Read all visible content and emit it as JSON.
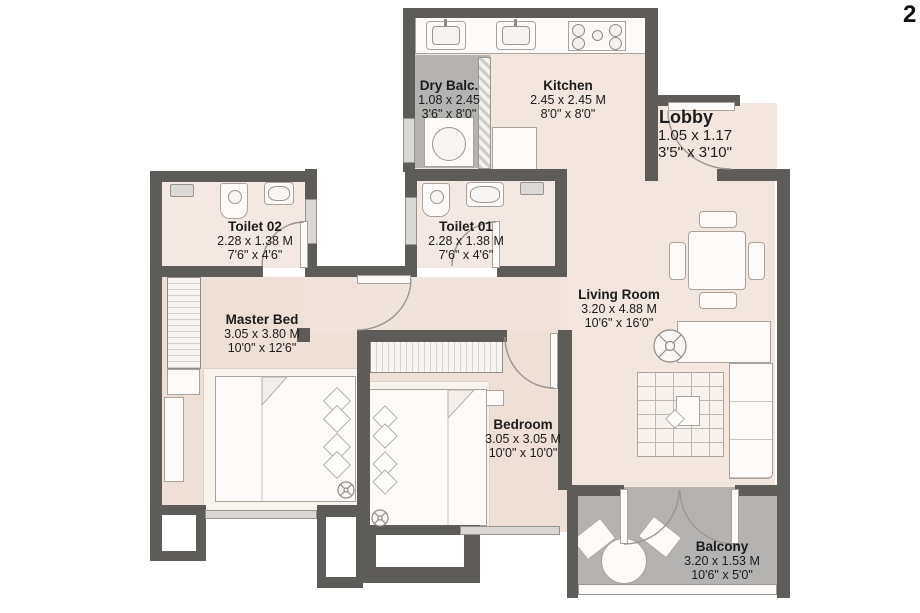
{
  "page": {
    "corner_mark": "2"
  },
  "colors": {
    "wall": "#5d5c59",
    "text": "#1c1c1c",
    "pink": "#f2e6df",
    "pinkdeep": "#eedfd7",
    "gray": "#b4b3b1"
  },
  "rooms": [
    {
      "id": "dry_balc",
      "name": "Dry Balc.",
      "dim_m": "1.08 x 2.45",
      "dim_ft": "3'6\" x 8'0\""
    },
    {
      "id": "kitchen",
      "name": "Kitchen",
      "dim_m": "2.45 x 2.45 M",
      "dim_ft": "8'0\" x 8'0\""
    },
    {
      "id": "lobby",
      "name": "Lobby",
      "dim_m": "1.05 x 1.17",
      "dim_ft": "3'5\" x 3'10\""
    },
    {
      "id": "toilet02",
      "name": "Toilet 02",
      "dim_m": "2.28 x 1.38 M",
      "dim_ft": "7'6\" x 4'6\""
    },
    {
      "id": "toilet01",
      "name": "Toilet 01",
      "dim_m": "2.28 x 1.38 M",
      "dim_ft": "7'6\" x 4'6\""
    },
    {
      "id": "living",
      "name": "Living Room",
      "dim_m": "3.20 x 4.88 M",
      "dim_ft": "10'6\" x 16'0\""
    },
    {
      "id": "master",
      "name": "Master Bed",
      "dim_m": "3.05 x 3.80 M",
      "dim_ft": "10'0\" x 12'6\""
    },
    {
      "id": "bedroom",
      "name": "Bedroom",
      "dim_m": "3.05 x 3.05 M",
      "dim_ft": "10'0\" x 10'0\""
    },
    {
      "id": "balcony",
      "name": "Balcony",
      "dim_m": "3.20 x 1.53 M",
      "dim_ft": "10'6\" x 5'0\""
    }
  ],
  "icons": [
    "kitchen-sink-icon",
    "hob-stove-icon",
    "washing-machine-icon",
    "refrigerator-icon",
    "shower-icon",
    "toilet-wc-icon",
    "washbasin-icon",
    "door-swing-icon",
    "dining-table-icon",
    "dining-chair-icon",
    "sofa-icon",
    "rug-icon",
    "coffee-table-icon",
    "ceiling-fan-icon",
    "double-bed-icon",
    "pillow-icon",
    "wardrobe-icon",
    "dresser-icon",
    "bedside-table-icon",
    "outdoor-round-table-icon",
    "outdoor-chair-icon",
    "balcony-railing"
  ]
}
